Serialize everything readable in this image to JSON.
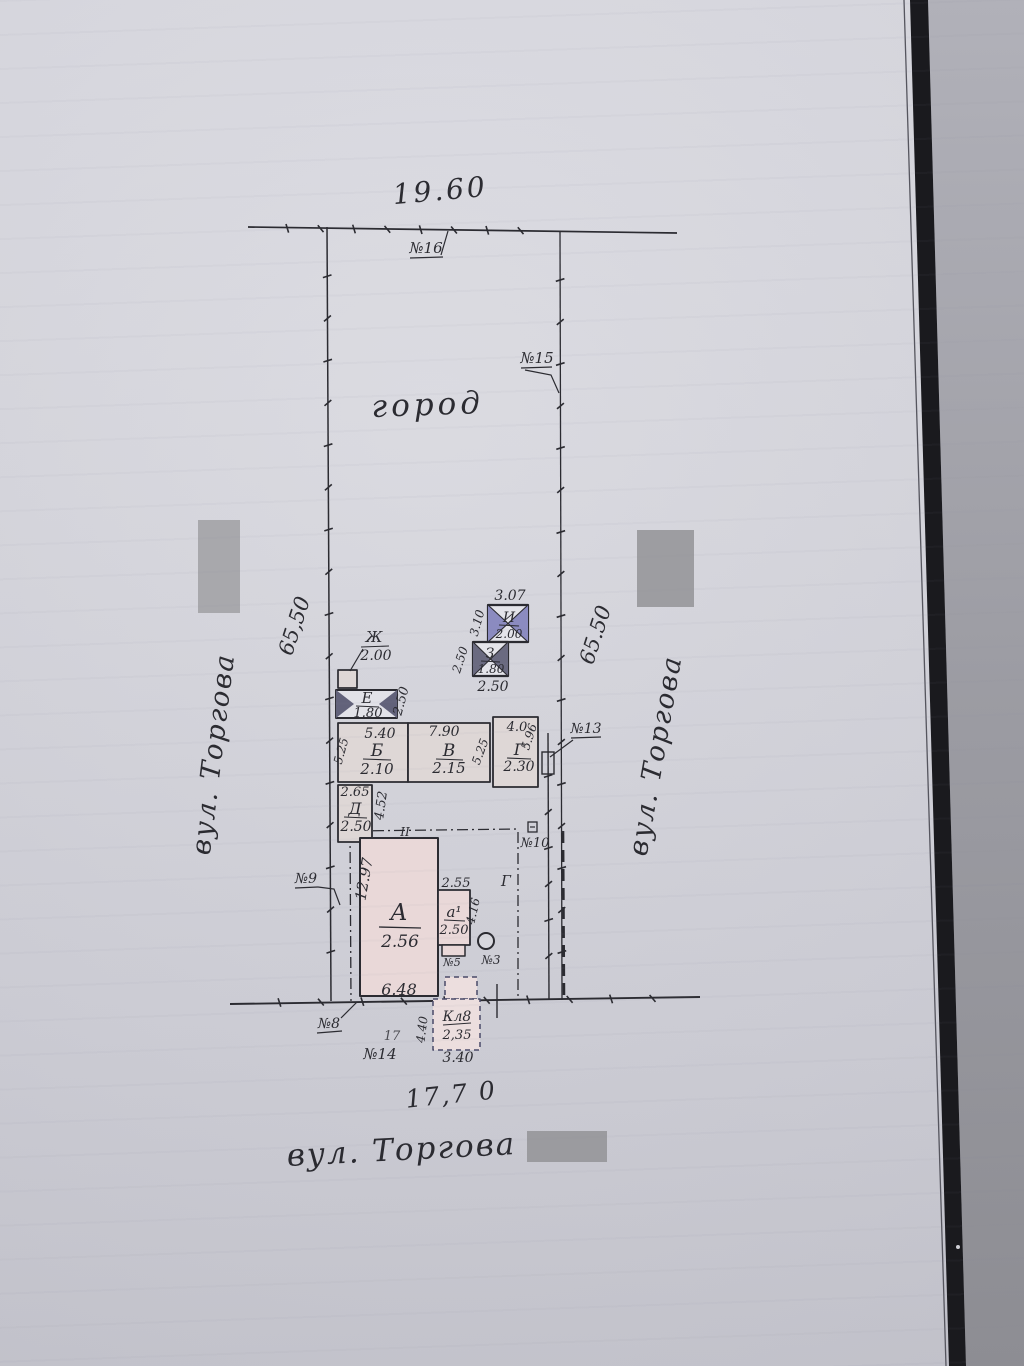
{
  "plan": {
    "top_dim": "19.60",
    "bottom_width_dim": "17,7 0",
    "garden": "город",
    "street_left": "вул. Торгова",
    "street_right": "вул. Торгова",
    "street_bottom": "вул. Торгова",
    "side_dim_left": "65,50",
    "side_dim_right": "65.50",
    "section_mark": "II",
    "gate_mark": "Г",
    "faint_number": "17",
    "markers": {
      "m16": "№16",
      "m15": "№15",
      "m13": "№13",
      "m10": "№10",
      "m9": "№9",
      "m8": "№8",
      "m14": "№14",
      "m5": "№5",
      "m3": "№3"
    },
    "buildings": {
      "zh": {
        "label": "Ж",
        "value": "2.00"
      },
      "e": {
        "label": "Е",
        "value": "1.80",
        "dim_right": "2.50"
      },
      "b": {
        "label": "Б",
        "value": "2.10",
        "dim_top": "5.40",
        "dim_left": "5.25"
      },
      "v": {
        "label": "В",
        "value": "2.15",
        "dim_top": "7.90",
        "dim_right": "5.25"
      },
      "g": {
        "label": "Г",
        "value": "2.30",
        "dim_top": "4.0",
        "dim_right": "5.96"
      },
      "d": {
        "label": "Д",
        "value": "2.50",
        "dim_top": "2.65",
        "dim_right": "4.52"
      },
      "a": {
        "label": "А",
        "value": "2.56",
        "dim_left": "12.97",
        "dim_bottom": "6.48"
      },
      "a1": {
        "label": "а¹",
        "value": "2.50",
        "dim_top": "2.55",
        "dim_right": "4.16"
      },
      "i": {
        "label": "И",
        "value": "2.00",
        "dim_top": "3.07",
        "dim_left": "3.10"
      },
      "z": {
        "label": "З",
        "value": "1.80",
        "dim_left": "2.50",
        "dim_bottom": "2.50"
      },
      "kl": {
        "label": "Кл8",
        "value": "2,35",
        "dim_left": "4.40",
        "dim_bottom": "3.40"
      }
    },
    "colors": {
      "ink": "#2b2b31",
      "pink_fill": "#e9d8d8",
      "blue_fill": "#8b8bc0",
      "dark_fill": "#62627a",
      "redaction": "#a2a2a6",
      "binding_band": "#1a1a1e"
    }
  }
}
